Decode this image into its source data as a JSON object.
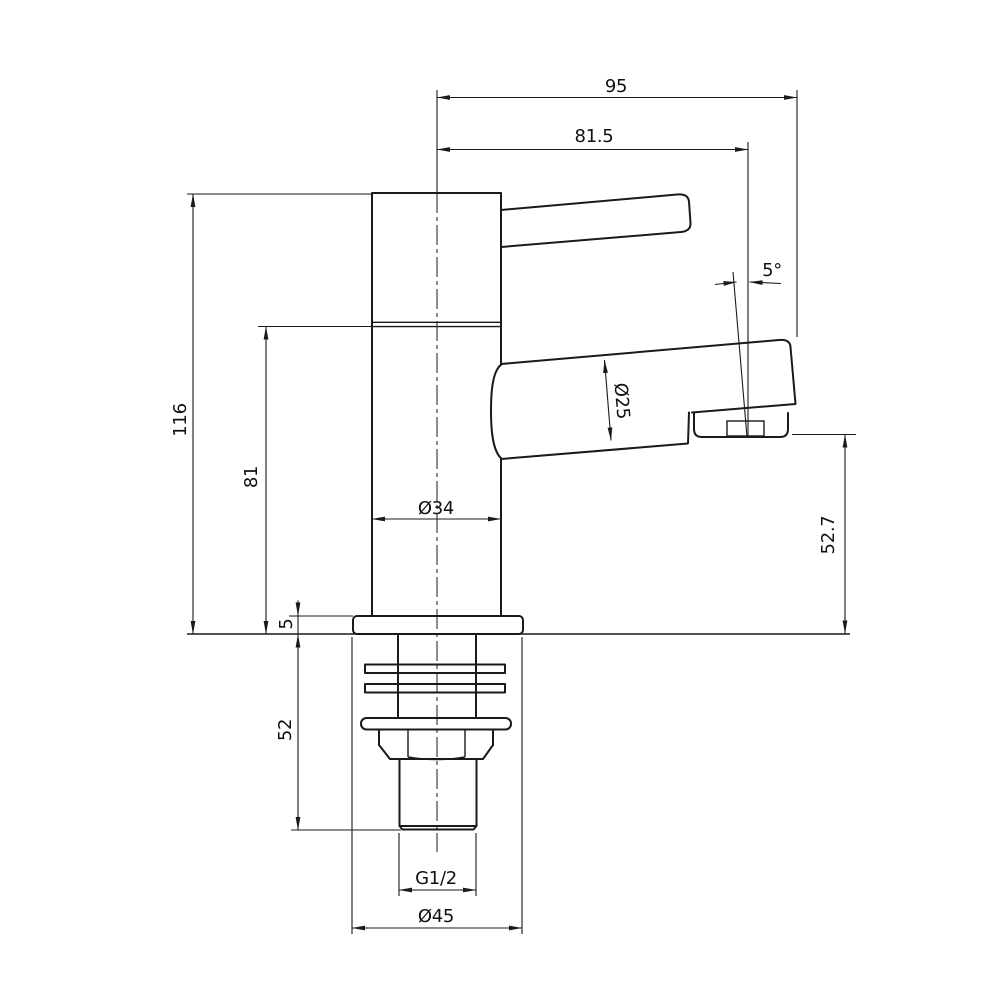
{
  "drawing": {
    "type": "technical-drawing",
    "subject": "single-lever pillar tap / faucet, side elevation with dimensions",
    "colors": {
      "line": "#1a1a1a",
      "background": "#ffffff"
    },
    "dims": {
      "overall_width": "95",
      "spout_reach": "81.5",
      "outlet_angle": "5°",
      "spout_diameter": "Ø25",
      "overall_height": "116",
      "body_height": "81",
      "body_diameter": "Ø34",
      "outlet_height": "52.7",
      "flange_thickness": "5",
      "shank_length": "52",
      "thread_size": "G1/2",
      "base_diameter": "Ø45"
    }
  }
}
